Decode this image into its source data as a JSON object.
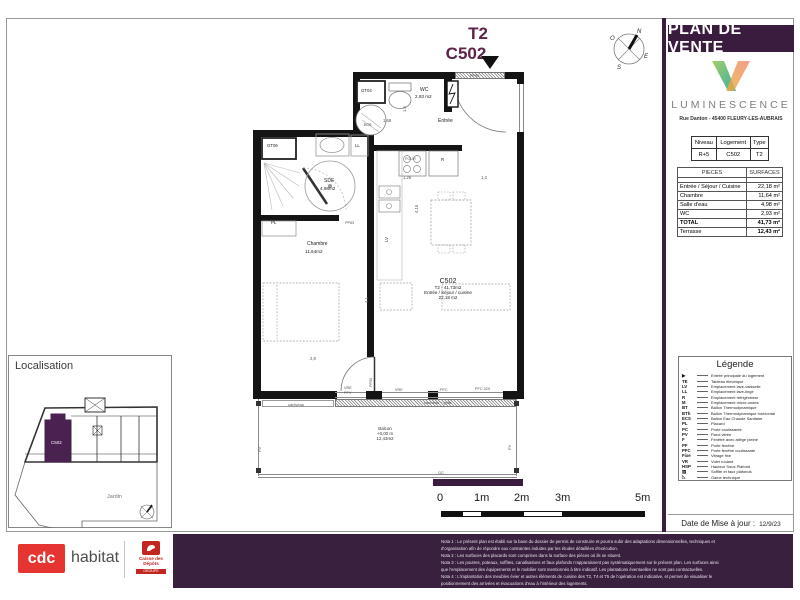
{
  "doc": {
    "type_label": "T2",
    "unit": "C502"
  },
  "sidebar": {
    "title": "PLAN DE VENTE",
    "brand": {
      "name": "LUMINESCENCE",
      "address": "Rue Danton - 45400 FLEURY-LES-AUBRAIS"
    },
    "unit_table": {
      "h1": "Niveau",
      "h2": "Logement",
      "h3": "Type",
      "v1": "R+5",
      "v2": "C502",
      "v3": "T2"
    },
    "surfaces": {
      "h_name": "PIECES",
      "h_value": "SURFACES",
      "rows": [
        {
          "n": "Entrée / Séjour / Cuisine",
          "v": "22,18 m²"
        },
        {
          "n": "Chambre",
          "v": "11,64 m²"
        },
        {
          "n": "Salle d'eau",
          "v": "4,98 m²"
        },
        {
          "n": "WC",
          "v": "2,93 m²"
        },
        {
          "n": "TOTAL",
          "v": "41,73 m²"
        },
        {
          "n": "Terrasse",
          "v": "12,43 m²"
        }
      ]
    },
    "legend": {
      "title": "Légende",
      "items": [
        {
          "a": "▶",
          "l": "Entrée principale du logement"
        },
        {
          "a": "TE",
          "l": "Tableau électrique"
        },
        {
          "a": "LV",
          "l": "Emplacement lave-vaisselle"
        },
        {
          "a": "LL",
          "l": "Emplacement lave-linge"
        },
        {
          "a": "R",
          "l": "Emplacement réfrigérateur"
        },
        {
          "a": "M",
          "l": "Emplacement micro-ondes"
        },
        {
          "a": "BT",
          "l": "Ballon Thermodynamique"
        },
        {
          "a": "BTh",
          "l": "Ballon Thermodynamique horizontal"
        },
        {
          "a": "ECS",
          "l": "Ballon Eau Chaude Sanitaire"
        },
        {
          "a": "PL",
          "l": "Placard"
        },
        {
          "a": "PC",
          "l": "Porte coulissante"
        },
        {
          "a": "PV",
          "l": "Paroi vitrée"
        },
        {
          "a": "F",
          "l": "Fenêtre avec allège pleine"
        },
        {
          "a": "PF",
          "l": "Porte fenêtre"
        },
        {
          "a": "PFC",
          "l": "Porte fenêtre coulissante"
        },
        {
          "a": "Fixe",
          "l": "Vitrage fixe"
        },
        {
          "a": "VR",
          "l": "Volet roulant"
        },
        {
          "a": "HSP",
          "l": "Hauteur Sous Plafond"
        },
        {
          "a": "▨",
          "l": "Soffite et faux plafonds"
        },
        {
          "a": "◺",
          "l": "Gaine technique"
        }
      ]
    },
    "date_label": "Date de Mise à jour :",
    "date_value": "12/9/23"
  },
  "plan": {
    "labels": {
      "gt04": "GT04",
      "wc": "WC",
      "wc_area": "2,93 m2",
      "entree": "Entrée",
      "pp90_top": "PP90",
      "gt06": "GT06",
      "ll": "LL",
      "sde": "SDE",
      "sde_area": "4,98m2",
      "pl": "PL",
      "pp63": "PP63",
      "chambre": "Chambre",
      "chambre_area": "11,64m2",
      "four": "FOUR",
      "r": "R",
      "lv": "LV",
      "unit_l1": "C502",
      "unit_l2": "T2 - 41,73m2",
      "unit_l3": "Entrée / Séjour / cuisine",
      "unit_l4": "22,18 m2",
      "d1": "1,68",
      "d2": "1,6",
      "d3": "1,26",
      "d4": "1,3",
      "d5": "4,15",
      "d6": "2,8",
      "d7": "4,1",
      "vre1": "VRE",
      "pfv": "PFV",
      "pp90_bed": "PP90",
      "caniveau": "caniveau",
      "vre2": "VRE",
      "caniveau_grille": "caniveau + grille",
      "pfc": "PFC",
      "pfc329": "PFC 329",
      "balcon_l1": "Balcon",
      "balcon_l2": "+0,00 m",
      "balcon_l3": "12,43m2",
      "pv_left": "PV",
      "pv_right": "PV",
      "gc": "GC",
      "ecs": "ECS"
    }
  },
  "scale": {
    "t0": "0",
    "t1": "1m",
    "t2": "2m",
    "t3": "3m",
    "t5": "5m"
  },
  "loc": {
    "title": "Localisation",
    "unit": "C502",
    "garden": "Jardin"
  },
  "compass": {
    "n": "N",
    "o": "O",
    "e": "E",
    "s": "S"
  },
  "footer": {
    "cdc": "cdc",
    "habitat": "habitat",
    "caisse": "Caisse des Dépôts",
    "groupe": "GROUPE",
    "notes": [
      "Nota 1 : Le présent plan est établi sur la base du dossier de permis de construire et pourra subir des adaptations dimensionnelles, techniques et",
      "d'organisation afin de répondre aux contraintes induites par les études détaillées d'exécution.",
      "Nota 2 : Les surfaces des placards sont comprises dans la surface des pièces où ils se situent.",
      "Nota 3 : Les poutres, poteaux, soffites, canalisations et faux plafonds n'apparaissent pas systématiquement sur le présent plan. Les surfaces ainsi",
      "que l'emplacement des équipements et le mobilier sont mentionnés à titre indicatif. Les plantations éventuelles ne sont pas contractuelles.",
      "Nota 4 : L'implantation des meubles évier et autres éléments de cuisine des T2, T4 et T5 de l'opération est indicative, et permet de visualiser le",
      "positionnement des arrivées et évacuations d'eau à l'intérieur des logements."
    ]
  }
}
